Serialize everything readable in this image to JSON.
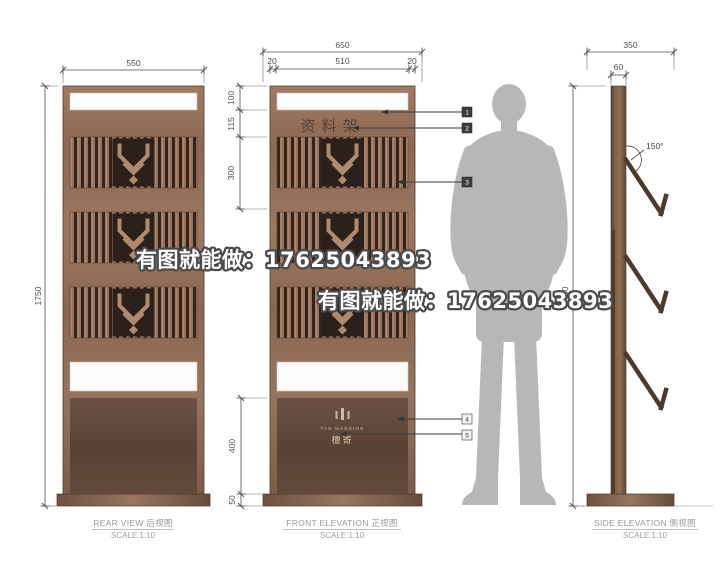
{
  "drawing_type": "display-stand-elevations",
  "views": {
    "rear": {
      "title": "REAR VIEW 后视图",
      "scale": "SCALE:1:10",
      "dims": {
        "width": "550",
        "height": "1750"
      }
    },
    "front": {
      "title": "FRONT ELEVATION 正视图",
      "scale": "SCALE:1:10",
      "sign": "资料架",
      "dims": {
        "total_width": "650",
        "margin_left": "20",
        "inner_width": "510",
        "margin_right": "20",
        "seg_top": "100",
        "seg_band": "115",
        "seg_rack": "300",
        "seg_panel": "400",
        "seg_base": "50"
      },
      "callouts": {
        "t1": "1",
        "t2": "2",
        "t3": "3",
        "t4": "4",
        "t5": "5"
      },
      "logo": {
        "latin": "TAN MANSION",
        "cn": "檀寄"
      }
    },
    "side": {
      "title": "SIDE ELEVATION 侧视图",
      "scale": "SCALE:1:10",
      "dims": {
        "total_width": "350",
        "post_width": "60",
        "height": "1750"
      },
      "angle": "150°"
    }
  },
  "watermarks": {
    "wm1": "有图就能做：17625043893",
    "wm2": "有图就能做：17625043893"
  },
  "colors": {
    "copper": "#96735d",
    "dark_wood": "#5d4536",
    "silhouette": "#b7b7b7",
    "dimension": "#4e4e4e"
  }
}
